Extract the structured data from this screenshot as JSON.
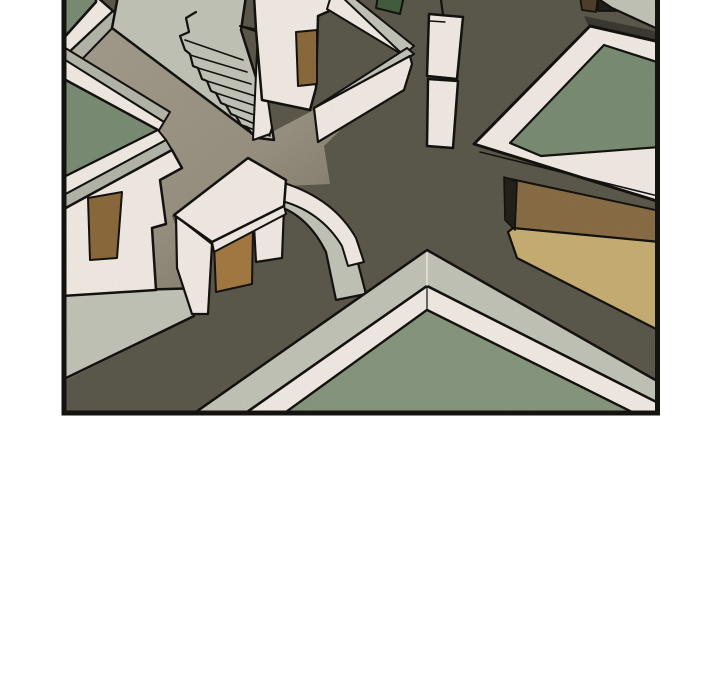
{
  "page": {
    "background_color": "#ffffff"
  },
  "panel": {
    "alt_text": "Comic panel: bird's-eye aerial view of a village crossroads with flat-roofed white houses, green rooftop courtyards, a staircase alley, a white chimney pillar, a tan mud-brick building and dark earthen roads. No text or UI controls are present.",
    "border_color": "#15130f"
  },
  "palette": {
    "ink": "#15130f",
    "road_dark": "#5e5a4e",
    "road_warm": "#a8a192",
    "road_mid": "#9c9585",
    "road_deep": "#6e695b",
    "wall_white": "#f7f0e9",
    "wall_gray": "#c7c8bc",
    "band_gray": "#b9baae",
    "tread_gray": "#d0d1c6",
    "roof_green": "#7e9077",
    "roof_green_light": "#8a9a81",
    "roof_green_dark": "#44603f",
    "door_brown": "#8f6c3e",
    "door_brown_light": "#a87c44",
    "tan_khaki": "#cbb276",
    "tan_brown": "#8c7048",
    "opening_dark": "#26221b",
    "shadow_dark": "#3d3b33",
    "roof_block_brown": "#51402c",
    "roof_block_dark": "#241f19",
    "noise_opacity": "0.07"
  },
  "scene": {
    "elements": [
      "dark-road",
      "warm-road",
      "green-roof-top-left",
      "green-courtyard-left",
      "house-row-with-brown-door",
      "stair-alley",
      "upper-house-with-brown-door",
      "zigzag-wall",
      "chimney-pillar",
      "green-roof-building-right",
      "tan-mudbrick-building",
      "gateway-with-brown-gate",
      "curved-wall",
      "chevron-corner-building",
      "green-courtyard-bottom",
      "rooftop-clutter-top-right"
    ]
  }
}
